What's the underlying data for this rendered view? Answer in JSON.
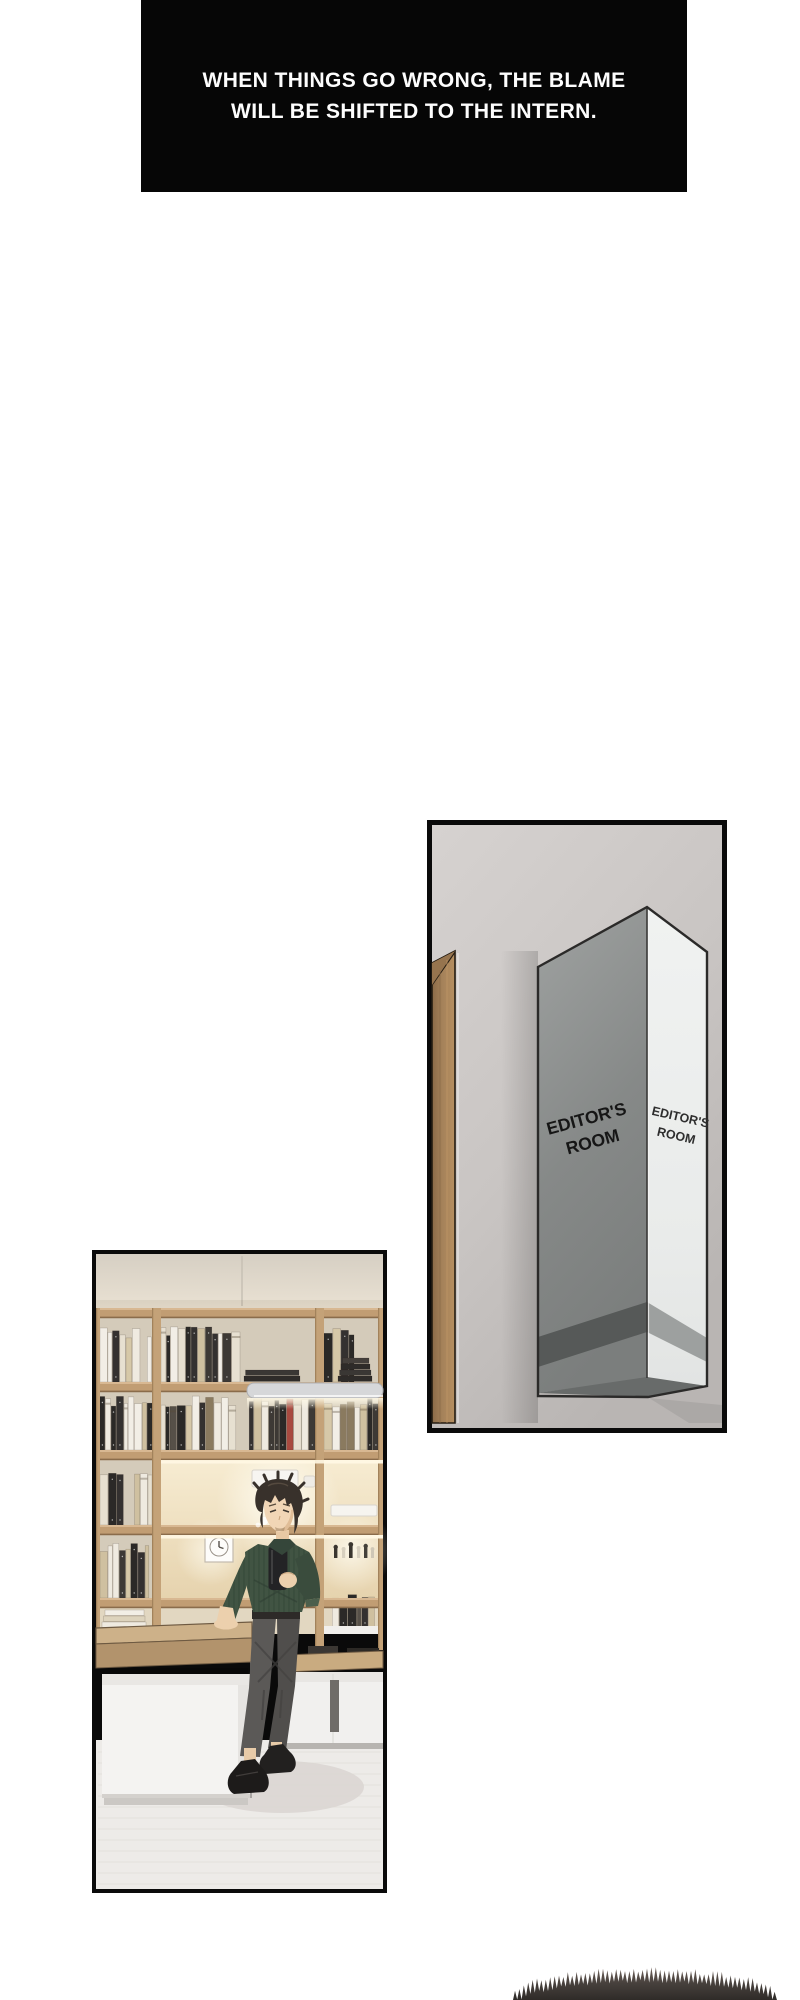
{
  "page": {
    "width": 800,
    "height": 2000,
    "background": "#ffffff"
  },
  "caption": {
    "lines": [
      "WHEN THINGS GO WRONG, THE BLAME",
      "WILL BE SHIFTED TO THE INTERN."
    ],
    "background": "#060606",
    "text_color": "#fdfdfd"
  },
  "panel_editors_room": {
    "sign": {
      "side_face": {
        "line1": "EDITOR'S",
        "line2": "ROOM"
      },
      "front_face": {
        "line1": "EDITOR'S",
        "line2": "ROOM"
      }
    },
    "colors": {
      "wall": "#cdc9c7",
      "sign_side_face": "#8d908f",
      "sign_front_face": "#eceeed",
      "stripe_dark": "#565958",
      "stripe_light": "#9da09f",
      "door_frame_wood": "#b28b5d",
      "panel_border": "#0a0a0a"
    }
  },
  "panel_library": {
    "colors": {
      "shelf_wood": "#c9a87e",
      "shelf_backlight": "#f4e6c6",
      "book_dark": "#2b2927",
      "book_white": "#efeae0",
      "book_cream": "#d6c8a8",
      "accent_book_red": "#a84a40",
      "shirt_green": "#415443",
      "pants_gray": "#5b5957",
      "skin": "#f1d6b6",
      "desk_wood": "#c9ab80",
      "cabinet_white": "#f4f3f1",
      "floor": "#edebe8",
      "panel_border": "#0a0a0a"
    }
  },
  "bottom_overlay": {
    "color": "#46403c"
  }
}
